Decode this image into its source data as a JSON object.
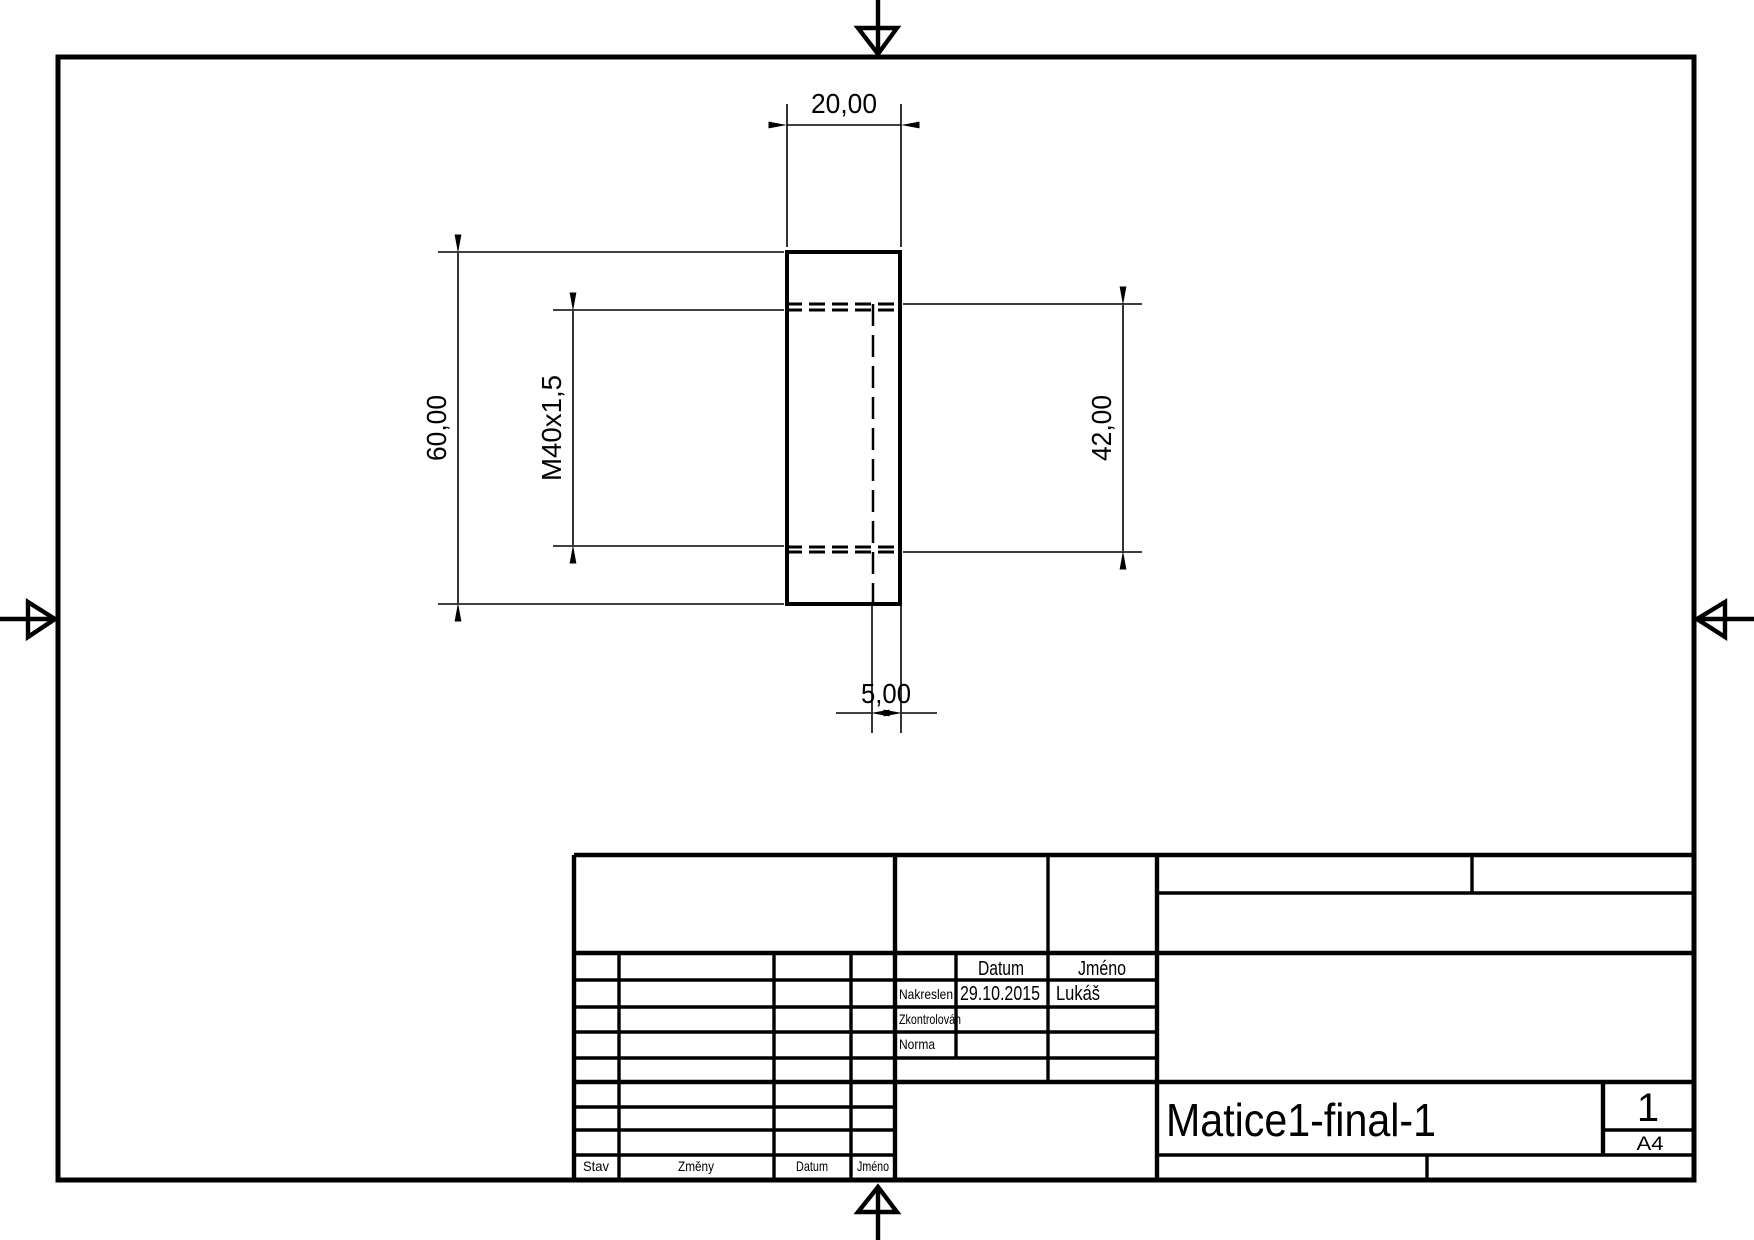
{
  "page": {
    "part_name": "Matice1-final-1",
    "sheet_number": "1",
    "paper_format": "A4"
  },
  "dimensions": {
    "width": "20,00",
    "height": "60,00",
    "thread": "M40x1,5",
    "bore": "42,00",
    "wall": "5,00"
  },
  "title_block": {
    "approval_table": {
      "col_datum": "Datum",
      "col_jmeno": "Jméno",
      "rows": [
        {
          "label": "Nakreslen",
          "datum": "29.10.2015",
          "jmeno": "Lukáš"
        },
        {
          "label": "Zkontrolován",
          "datum": "",
          "jmeno": ""
        },
        {
          "label": "Norma",
          "datum": "",
          "jmeno": ""
        }
      ]
    },
    "revision_table": {
      "col_stav": "Stav",
      "col_zmeny": "Změny",
      "col_datum": "Datum",
      "col_jmeno": "Jméno"
    },
    "part_name": "Matice1-final-1",
    "sheet_number": "1",
    "paper_format": "A4"
  },
  "colors": {
    "ink": "#000000",
    "paper": "#ffffff"
  }
}
